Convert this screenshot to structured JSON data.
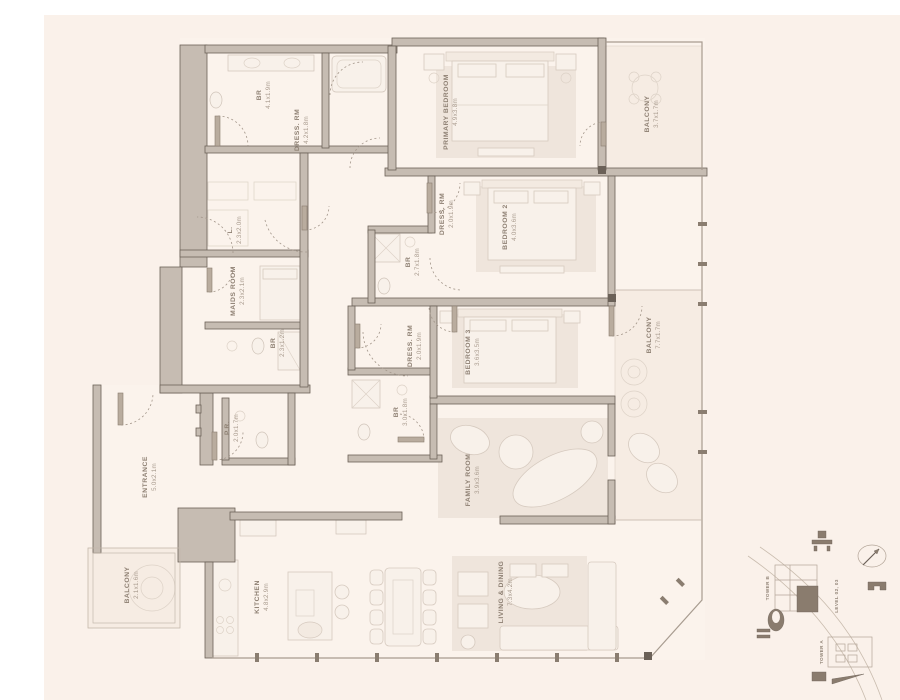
{
  "plan": {
    "colors": {
      "page_background": "#ffffff",
      "paper_background": "#faf1ea",
      "wall_fill": "#c6bcb2",
      "wall_outline": "#6b6158",
      "label_text": "#8d7f72",
      "dims_text": "#a89a8d",
      "unit_highlight": "#8a7c6e"
    },
    "rooms": [
      {
        "id": "br-top",
        "label": "BR",
        "dims": "4.1x1.9m"
      },
      {
        "id": "dress-rm-primary",
        "label": "DRESS. RM",
        "dims": "4.2x1.8m"
      },
      {
        "id": "primary-bedroom",
        "label": "PRIMARY BEDROOM",
        "dims": "4.9x3.8m"
      },
      {
        "id": "balcony-primary",
        "label": "BALCONY",
        "dims": "3.7x1.7m"
      },
      {
        "id": "dress-rm-bedroom2",
        "label": "DRESS. RM",
        "dims": "2.0x1.9m"
      },
      {
        "id": "bedroom-2",
        "label": "BEDROOM 2",
        "dims": "4.0x3.6m"
      },
      {
        "id": "br-bedroom2",
        "label": "BR",
        "dims": "2.7x1.8m"
      },
      {
        "id": "linen",
        "label": "L.",
        "dims": "2.3x2.0m"
      },
      {
        "id": "maids-room",
        "label": "MAIDS ROOM",
        "dims": "2.3x2.1m"
      },
      {
        "id": "br-maids",
        "label": "BR",
        "dims": "2.3x1.2m"
      },
      {
        "id": "dress-rm-bedroom3",
        "label": "DRESS. RM",
        "dims": "2.0x1.9m"
      },
      {
        "id": "br-bedroom3",
        "label": "BR",
        "dims": "3.0x1.8m"
      },
      {
        "id": "bedroom-3",
        "label": "BEDROOM 3",
        "dims": "3.6x3.5m"
      },
      {
        "id": "family-room",
        "label": "FAMILY ROOM",
        "dims": "3.9x3.6m"
      },
      {
        "id": "balcony-main",
        "label": "BALCONY",
        "dims": "7.7x1.7m"
      },
      {
        "id": "entrance",
        "label": "ENTRANCE",
        "dims": "5.0x2.1m"
      },
      {
        "id": "powder-room",
        "label": "P.R.",
        "dims": "2.0x1.7m"
      },
      {
        "id": "balcony-kitchen",
        "label": "BALCONY",
        "dims": "2.1x1.6m"
      },
      {
        "id": "kitchen",
        "label": "KITCHEN",
        "dims": "4.8x2.9m"
      },
      {
        "id": "living-dining",
        "label": "LIVING & DINING",
        "dims": "7.3x4.2m"
      }
    ]
  },
  "site_map": {
    "tower_b_label": "TOWER B",
    "tower_a_label": "TOWER A",
    "level_label": "LEVEL 02, 03",
    "icons": [
      "compass",
      "bench",
      "marina",
      "pool",
      "boat"
    ]
  }
}
